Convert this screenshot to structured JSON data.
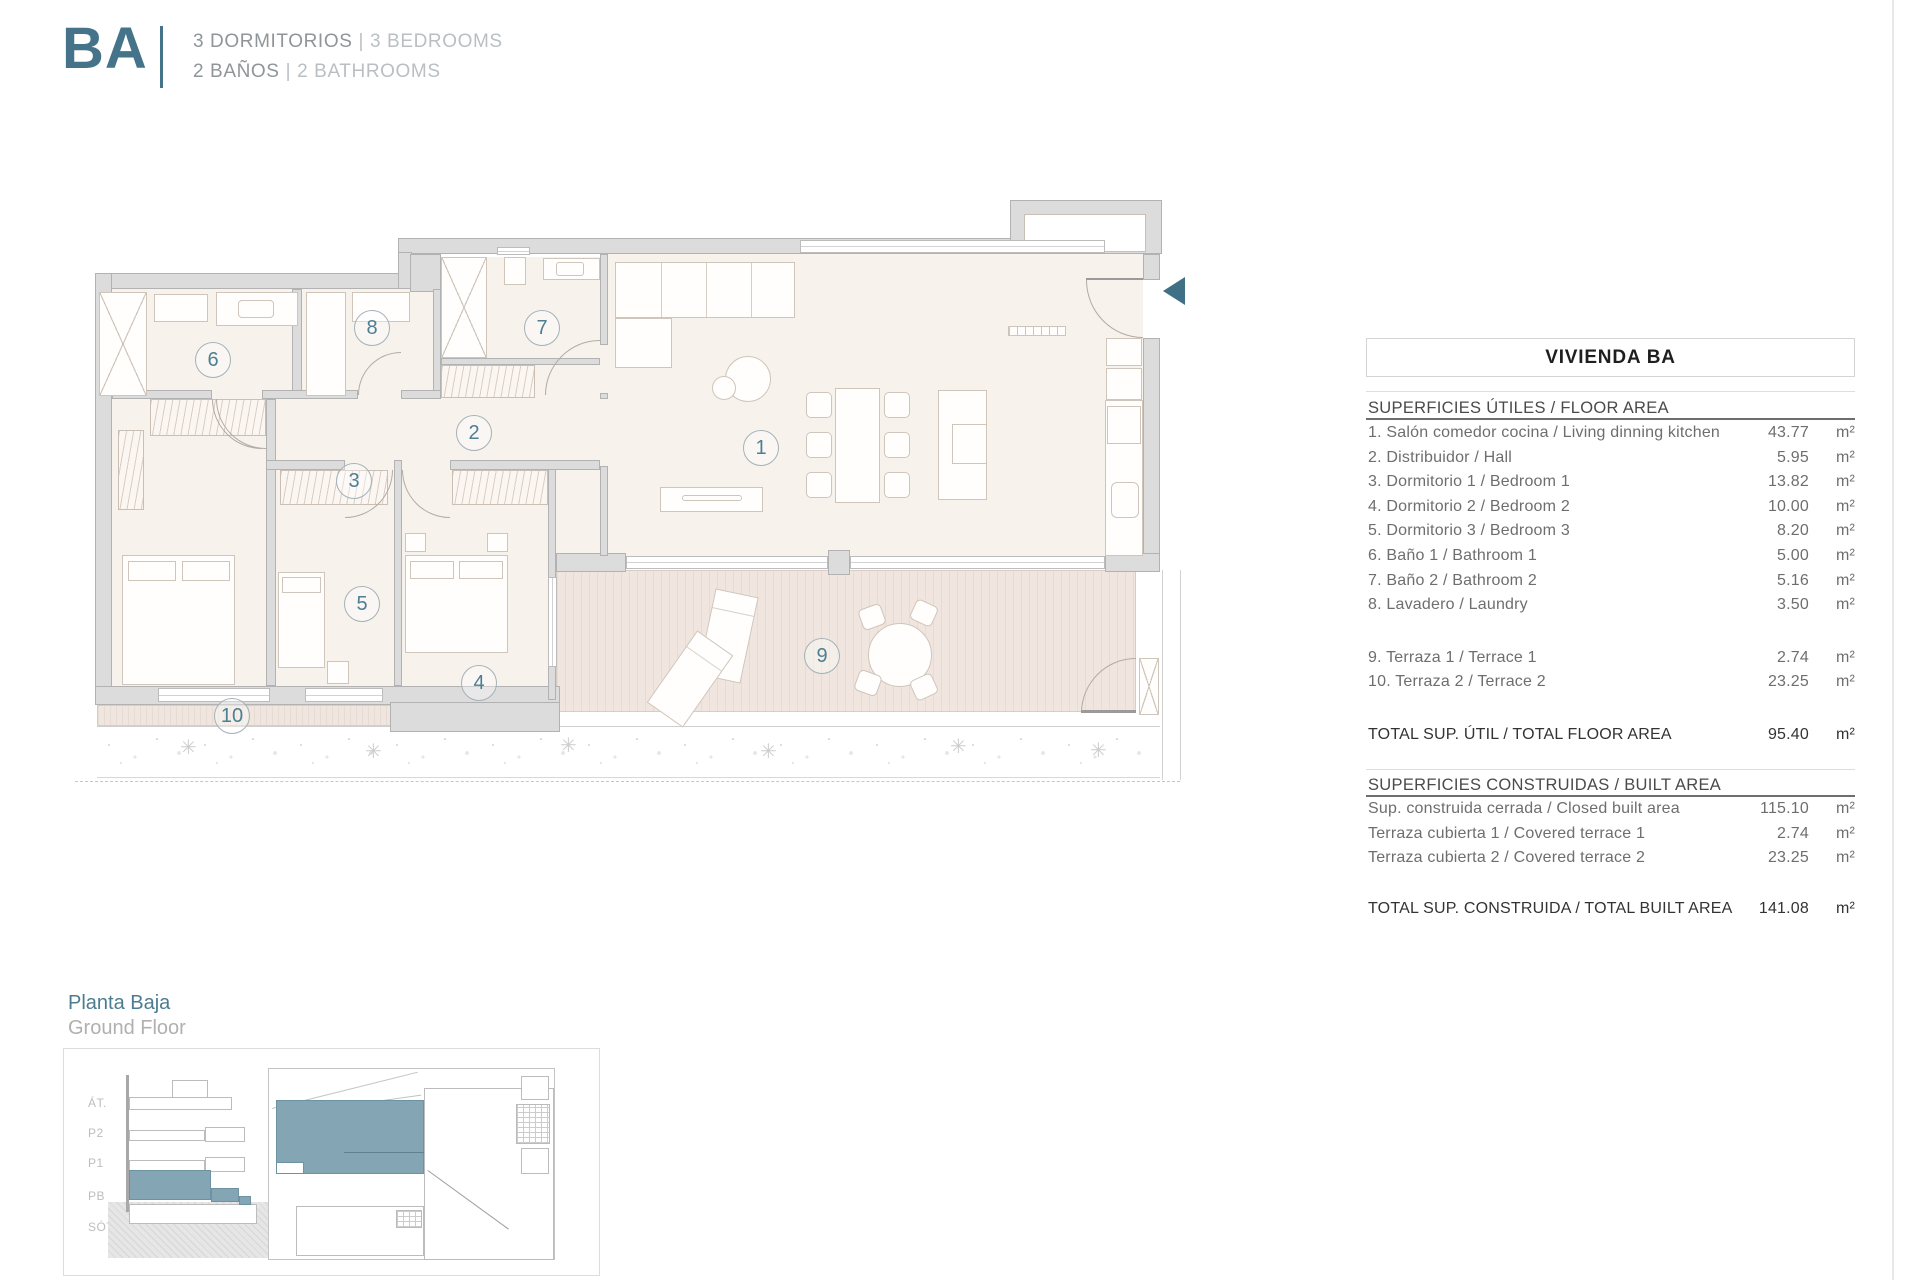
{
  "header": {
    "unit_code": "BA",
    "separator": "|",
    "bedrooms_es": "3 DORMITORIOS",
    "bedrooms_en": "3 BEDROOMS",
    "bathrooms_es": "2 BAÑOS",
    "bathrooms_en": "2 BATHROOMS"
  },
  "plan": {
    "room_labels": [
      "1",
      "2",
      "3",
      "4",
      "5",
      "6",
      "7",
      "8",
      "9",
      "10"
    ]
  },
  "area_table": {
    "title": "VIVIENDA BA",
    "useful": {
      "header": "SUPERFICIES ÚTILES / FLOOR AREA",
      "rows": [
        {
          "label": "1. Salón comedor cocina / Living dinning kitchen",
          "value": "43.77",
          "unit": "m²"
        },
        {
          "label": "2. Distribuidor / Hall",
          "value": "5.95",
          "unit": "m²"
        },
        {
          "label": "3. Dormitorio 1 / Bedroom 1",
          "value": "13.82",
          "unit": "m²"
        },
        {
          "label": "4. Dormitorio 2 / Bedroom 2",
          "value": "10.00",
          "unit": "m²"
        },
        {
          "label": "5. Dormitorio 3 / Bedroom 3",
          "value": "8.20",
          "unit": "m²"
        },
        {
          "label": "6. Baño 1 / Bathroom 1",
          "value": "5.00",
          "unit": "m²"
        },
        {
          "label": "7. Baño 2 / Bathroom 2",
          "value": "5.16",
          "unit": "m²"
        },
        {
          "label": "8. Lavadero / Laundry",
          "value": "3.50",
          "unit": "m²"
        }
      ],
      "terrace_rows": [
        {
          "label": "9. Terraza 1 / Terrace 1",
          "value": "2.74",
          "unit": "m²"
        },
        {
          "label": "10. Terraza 2 / Terrace 2",
          "value": "23.25",
          "unit": "m²"
        }
      ],
      "total": {
        "label": "TOTAL SUP. ÚTIL / TOTAL FLOOR AREA",
        "value": "95.40",
        "unit": "m²"
      }
    },
    "built": {
      "header": "SUPERFICIES CONSTRUIDAS / BUILT AREA",
      "rows": [
        {
          "label": "Sup. construida cerrada / Closed built area",
          "value": "115.10",
          "unit": "m²"
        },
        {
          "label": "Terraza cubierta 1 / Covered terrace 1",
          "value": "2.74",
          "unit": "m²"
        },
        {
          "label": "Terraza cubierta 2 / Covered terrace 2",
          "value": "23.25",
          "unit": "m²"
        }
      ],
      "total": {
        "label": "TOTAL SUP. CONSTRUIDA /  TOTAL BUILT AREA",
        "value": "141.08",
        "unit": "m²"
      }
    }
  },
  "floor_label": {
    "es": "Planta Baja",
    "en": "Ground Floor"
  },
  "mini_diagram": {
    "levels": [
      "ÁT.",
      "P2",
      "P1",
      "PB",
      "SÓT."
    ]
  },
  "colors": {
    "accent_teal": "#3f7086",
    "highlight_fill": "#84a6b4",
    "floor_beige": "#f8f2ed",
    "terrace": "#f0e6df",
    "wall_gray": "#dcdcdc"
  }
}
